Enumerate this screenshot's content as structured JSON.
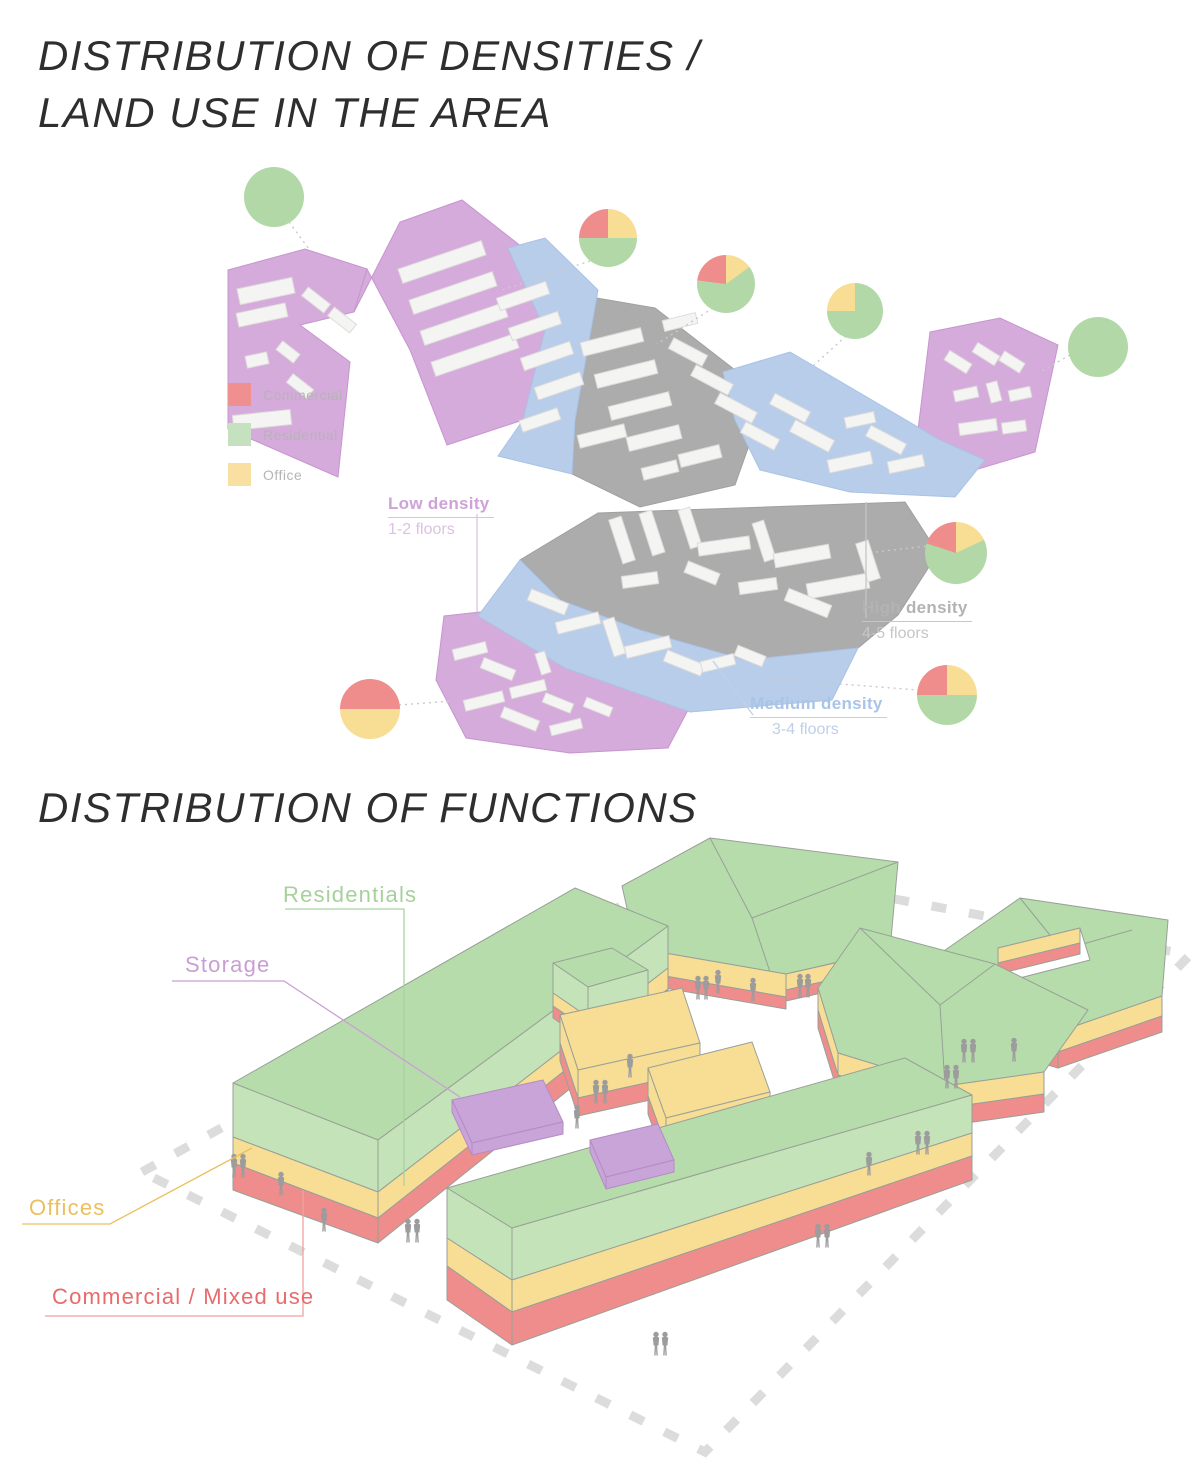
{
  "densities": {
    "title_line1": "DISTRIBUTION OF DENSITIES /",
    "title_line2": "LAND USE IN THE AREA",
    "legend": {
      "items": [
        {
          "label": "Commercial",
          "color": "#ef8f8f"
        },
        {
          "label": "Residential",
          "color": "#c6e1c0"
        },
        {
          "label": "Office",
          "color": "#f9dfa2"
        }
      ]
    },
    "density_zones": [
      {
        "name": "Low density",
        "floors": "1-2 floors",
        "text_color": "#cfa2d8",
        "sub_color": "#dcc2e2"
      },
      {
        "name": "High density",
        "floors": "4-5 floors",
        "text_color": "#b3b3b3",
        "sub_color": "#c6c6c6"
      },
      {
        "name": "Medium density",
        "floors": "3-4 floors",
        "text_color": "#a9c4e6",
        "sub_color": "#bed0ea"
      }
    ],
    "pies": [
      {
        "id": 1,
        "cx": 274,
        "cy": 197,
        "r": 30,
        "segments": [
          {
            "color": "#b2d8a8",
            "pct": 100
          }
        ]
      },
      {
        "id": 2,
        "cx": 608,
        "cy": 238,
        "r": 29,
        "segments": [
          {
            "color": "#f8dd94",
            "pct": 25
          },
          {
            "color": "#b2d8a8",
            "pct": 50
          },
          {
            "color": "#ef8d8d",
            "pct": 25
          }
        ]
      },
      {
        "id": 3,
        "cx": 726,
        "cy": 284,
        "r": 29,
        "segments": [
          {
            "color": "#f8dd94",
            "pct": 15
          },
          {
            "color": "#b2d8a8",
            "pct": 62
          },
          {
            "color": "#ef8d8d",
            "pct": 23
          }
        ]
      },
      {
        "id": 4,
        "cx": 855,
        "cy": 311,
        "r": 28,
        "segments": [
          {
            "color": "#b2d8a8",
            "pct": 75
          },
          {
            "color": "#f8dd94",
            "pct": 25
          }
        ]
      },
      {
        "id": 5,
        "cx": 1098,
        "cy": 347,
        "r": 30,
        "segments": [
          {
            "color": "#b2d8a8",
            "pct": 100
          }
        ]
      },
      {
        "id": 6,
        "cx": 956,
        "cy": 553,
        "r": 31,
        "segments": [
          {
            "color": "#f8dd94",
            "pct": 18
          },
          {
            "color": "#b2d8a8",
            "pct": 62
          },
          {
            "color": "#ef8d8d",
            "pct": 20
          }
        ]
      },
      {
        "id": 7,
        "cx": 947,
        "cy": 695,
        "r": 30,
        "segments": [
          {
            "color": "#f8dd94",
            "pct": 25
          },
          {
            "color": "#b2d8a8",
            "pct": 50
          },
          {
            "color": "#ef8d8d",
            "pct": 25
          }
        ]
      },
      {
        "id": 8,
        "cx": 370,
        "cy": 709,
        "r": 30,
        "segments": [
          {
            "color": "#ef8d8d",
            "pct": 25
          },
          {
            "color": "#f8dd94",
            "pct": 50
          },
          {
            "color": "#ef8d8d",
            "pct": 25
          }
        ]
      }
    ]
  },
  "functions": {
    "title": "DISTRIBUTION OF FUNCTIONS",
    "labels": [
      {
        "label": "Residentials",
        "color": "#a5d19b"
      },
      {
        "label": "Storage",
        "color": "#c99fd3"
      },
      {
        "label": "Offices",
        "color": "#eac05e"
      },
      {
        "label": "Commercial / Mixed use",
        "color": "#e96a6a"
      }
    ]
  },
  "colors": {
    "residential-top": "#b7dcab",
    "residential-side": "#c5e3b8",
    "office-band": "#f8dd94",
    "commercial-band": "#ef8d8d",
    "storage-block": "#c9a4d8",
    "zone-low-density": "#d5abdb",
    "zone-medium-density": "#b7cdea",
    "zone-high-density": "#acacac",
    "map-building": "#f4f4f2",
    "people": "#9c9c9c",
    "boundary-dash": "#dcdcdc",
    "sketch-line": "#98a098",
    "leader-gray": "#c9c9c9",
    "leader-low": "#dcc2e2",
    "leader-high": "#c6c6c6",
    "leader-medium": "#bed0ea",
    "leader-residentials": "#a8d3a0",
    "leader-storage": "#c9a0d4",
    "leader-offices": "#eac05e",
    "leader-commercial": "#f0a0a0",
    "title-color": "#2e2e2e",
    "legend-text": "#b5b5b5"
  }
}
